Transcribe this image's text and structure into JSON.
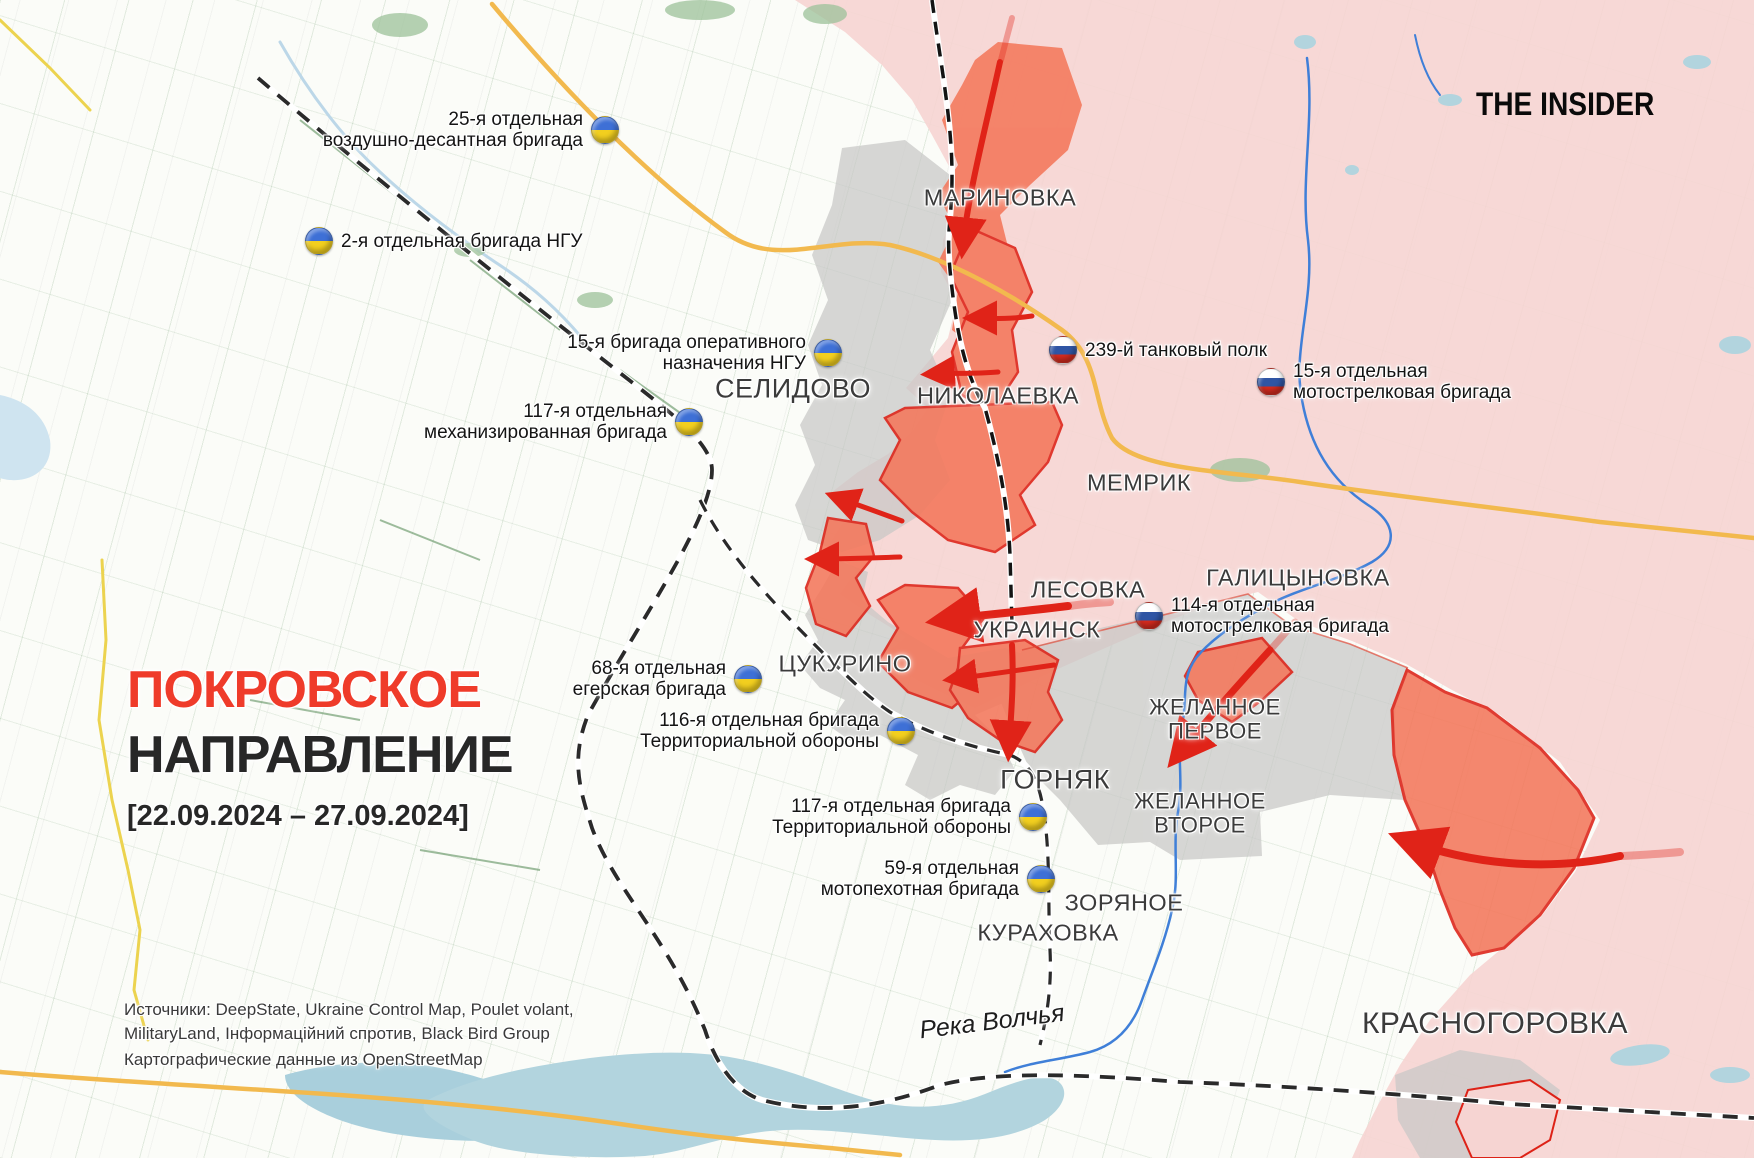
{
  "brand": "THE INSIDER",
  "title": {
    "line1": "ПОКРОВСКОЕ",
    "line2": "НАПРАВЛЕНИЕ",
    "date_range": "[22.09.2024 – 27.09.2024]"
  },
  "sources": {
    "line1": "Источники: DeepState, Ukraine Control Map, Poulet volant,",
    "line2": "MilitaryLand, Інформаційний спротив, Black Bird Group",
    "line3": "Картографические данные из OpenStreetMap"
  },
  "colors": {
    "accent_red": "#ef3b2a",
    "controlled_pink": "#f6d4d2",
    "advance_orange": "#f4775b",
    "advance_border": "#dd2217",
    "contested_gray": "#c8c8c6",
    "arrow_red": "#e02318",
    "water": "#b2d4de",
    "river_blue": "#3f7fd8",
    "road_orange": "#f2b94e",
    "road_yellow": "#ecd34f",
    "ua_flag_blue": "#3e70d6",
    "ua_flag_yellow": "#f2cf1f",
    "ru_flag_blue": "#2f55a4",
    "ru_flag_red": "#d52b1e"
  },
  "map": {
    "cities": [
      {
        "id": "marinovka",
        "lines": [
          "МАРИНОВКА"
        ],
        "x": 1000,
        "y": 198,
        "fs": 23.5
      },
      {
        "id": "selidovo",
        "lines": [
          "СЕЛИДОВО"
        ],
        "x": 793,
        "y": 389,
        "fs": 27
      },
      {
        "id": "nikolaevka",
        "lines": [
          "НИКОЛАЕВКА"
        ],
        "x": 998,
        "y": 396,
        "fs": 23.5
      },
      {
        "id": "memrik",
        "lines": [
          "МЕМРИК"
        ],
        "x": 1139,
        "y": 483,
        "fs": 23.5
      },
      {
        "id": "galitsynovka",
        "lines": [
          "ГАЛИЦЫНОВКА"
        ],
        "x": 1298,
        "y": 578,
        "fs": 23.5
      },
      {
        "id": "lesovka",
        "lines": [
          "ЛЕСОВКА"
        ],
        "x": 1088,
        "y": 590,
        "fs": 23.5
      },
      {
        "id": "ukrainsk",
        "lines": [
          "УКРАИНСК"
        ],
        "x": 1037,
        "y": 630,
        "fs": 23.5
      },
      {
        "id": "tsukurino",
        "lines": [
          "ЦУКУРИНО"
        ],
        "x": 845,
        "y": 664,
        "fs": 23.5
      },
      {
        "id": "zhelannoe-pervoe",
        "lines": [
          "ЖЕЛАННОЕ",
          "ПЕРВОЕ"
        ],
        "x": 1215,
        "y": 719,
        "fs": 22
      },
      {
        "id": "gornyak",
        "lines": [
          "ГОРНЯК"
        ],
        "x": 1055,
        "y": 780,
        "fs": 27
      },
      {
        "id": "zhelannoe-vtoroe",
        "lines": [
          "ЖЕЛАННОЕ",
          "ВТОРОЕ"
        ],
        "x": 1200,
        "y": 813,
        "fs": 22
      },
      {
        "id": "zoryanoe",
        "lines": [
          "ЗОРЯНОЕ"
        ],
        "x": 1124,
        "y": 903,
        "fs": 23.5
      },
      {
        "id": "kurakhovka",
        "lines": [
          "КУРАХОВКА"
        ],
        "x": 1048,
        "y": 933,
        "fs": 23.5
      },
      {
        "id": "krasnogorovka",
        "lines": [
          "КРАСНОГОРОВКА"
        ],
        "x": 1495,
        "y": 1024,
        "fs": 30
      }
    ],
    "water_label": {
      "text": "Река Волчья",
      "x": 992,
      "y": 1022
    },
    "units": [
      {
        "id": "ua-25-airborne",
        "side": "ua",
        "flag": "right",
        "fx": 604,
        "fy": 132,
        "lines": [
          "25-я отдельная",
          "воздушно-десантная бригада"
        ]
      },
      {
        "id": "ua-2-ngu",
        "side": "ua",
        "flag": "left",
        "fx": 320,
        "fy": 240,
        "lines": [
          "2-я отдельная бригада НГУ"
        ]
      },
      {
        "id": "ua-15-ngu",
        "side": "ua",
        "flag": "right",
        "fx": 827,
        "fy": 355,
        "lines": [
          "15-я бригада оперативного",
          "назначения НГУ"
        ]
      },
      {
        "id": "ua-117-mech",
        "side": "ua",
        "flag": "right",
        "fx": 688,
        "fy": 424,
        "lines": [
          "117-я отдельная",
          "механизированная бригада"
        ]
      },
      {
        "id": "ua-68-jaeger",
        "side": "ua",
        "flag": "right",
        "fx": 747,
        "fy": 681,
        "lines": [
          "68-я отдельная",
          "егерская бригада"
        ]
      },
      {
        "id": "ua-116-td",
        "side": "ua",
        "flag": "right",
        "fx": 900,
        "fy": 733,
        "lines": [
          "116-я отдельная бригада",
          "Территориальной обороны"
        ]
      },
      {
        "id": "ua-117-td",
        "side": "ua",
        "flag": "right",
        "fx": 1032,
        "fy": 819,
        "lines": [
          "117-я отдельная бригада",
          "Территориальной обороны"
        ]
      },
      {
        "id": "ua-59-motor",
        "side": "ua",
        "flag": "right",
        "fx": 1040,
        "fy": 881,
        "lines": [
          "59-я отдельная",
          "мотопехотная бригада"
        ]
      },
      {
        "id": "ru-239-tank",
        "side": "ru",
        "flag": "left",
        "fx": 1064,
        "fy": 349,
        "lines": [
          "239-й танковый полк"
        ]
      },
      {
        "id": "ru-15-motor",
        "side": "ru",
        "flag": "left",
        "fx": 1272,
        "fy": 384,
        "lines": [
          "15-я отдельная",
          "мотострелковая бригада"
        ]
      },
      {
        "id": "ru-114-motor",
        "side": "ru",
        "flag": "left",
        "fx": 1150,
        "fy": 618,
        "lines": [
          "114-я отдельная",
          "мотострелковая бригада"
        ]
      }
    ]
  }
}
